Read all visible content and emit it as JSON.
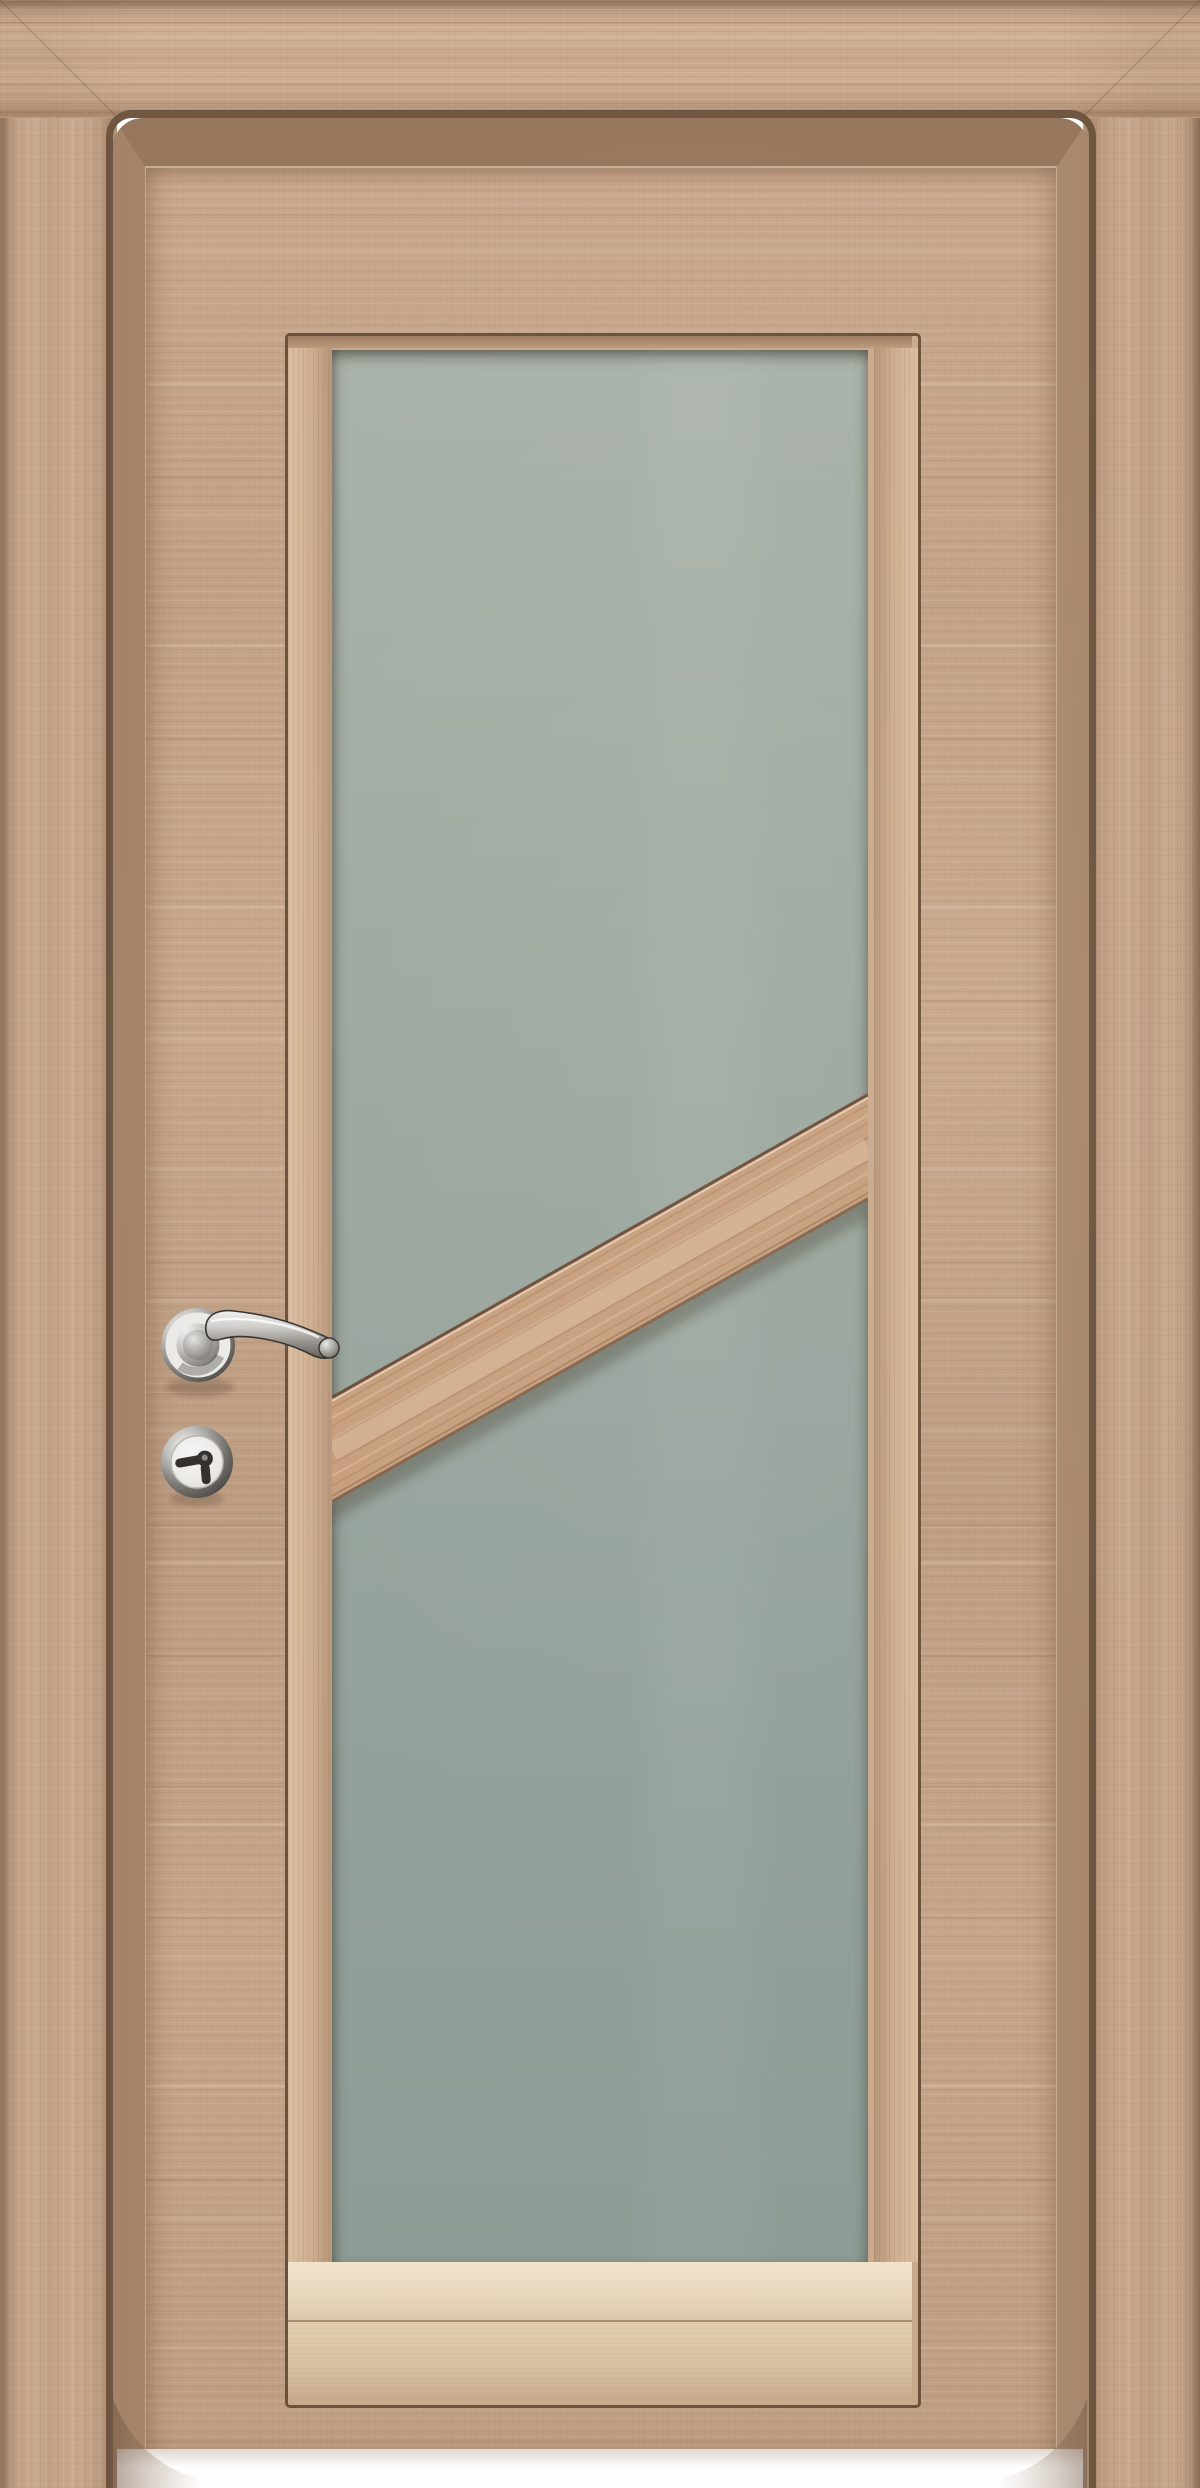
{
  "scene": {
    "type": "product photo",
    "subject": "Interior wooden door with frosted glass panel",
    "caption": "Light oak laminate interior door in stepped casing; tall frosted glass insert with a diagonal wood glazing bar, chrome lever handle on round rose and security thumbturn escutcheon; white floor background",
    "background_color": "#ffffff"
  },
  "door": {
    "wood_base": "#c5a58a",
    "wood_light": "#d0b298",
    "wood_dark": "#a2846c",
    "groove_color": "#6f5742",
    "bevel_top": "#97785e",
    "bevel_side": "#a5846a",
    "frame_outline": "#6b523c"
  },
  "glass": {
    "fill_top": "#aab3aa",
    "fill_bottom": "#8d9c96",
    "sill_bright": "#eee0c8",
    "sill_tan": "#dcc2a6"
  },
  "glazing_bar": {
    "wood": "#c79f7d",
    "edge": "#5c402c",
    "orientation": "diagonal, rising from lower left to upper right"
  },
  "hardware": {
    "handle_type": "lever handle on round rose",
    "lock_type": "security escutcheon with thumbturn",
    "chrome_bright": "#f4f3f1",
    "chrome_mid": "#98948f",
    "chrome_dark": "#45423e"
  },
  "floor": {
    "color": "#ffffff"
  }
}
